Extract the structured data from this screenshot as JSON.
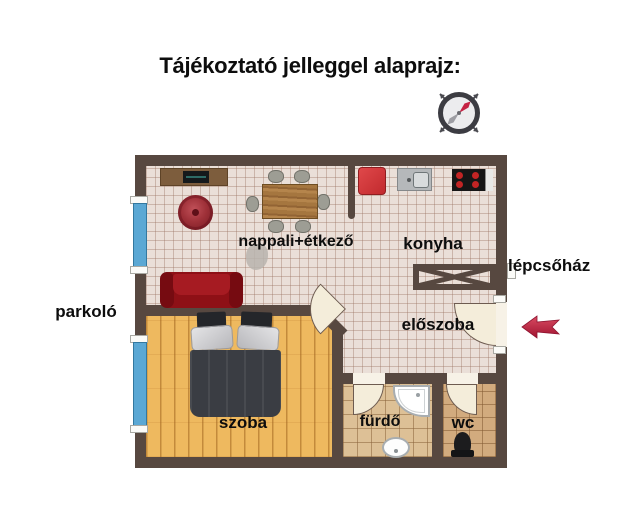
{
  "title": "Tájékoztató jelleggel alaprajz:",
  "rooms": {
    "nappali": {
      "label": "nappali+étkező"
    },
    "konyha": {
      "label": "konyha"
    },
    "eloszoba": {
      "label": "előszoba"
    },
    "szoba": {
      "label": "szoba"
    },
    "furdo": {
      "label": "fürdő"
    },
    "wc": {
      "label": "wc"
    }
  },
  "outside": {
    "parkolo": {
      "label": "parkoló"
    },
    "lepcsohaz": {
      "label": "lépcsőház"
    }
  },
  "icons": {
    "compass": "compass-icon",
    "entrance_arrow": "entrance-arrow-icon"
  },
  "colors": {
    "wall": "#574840",
    "tile_floor": "#eadfd8",
    "wood_floor": "#eeb95f",
    "bath_tile": "#ddc096",
    "wc_tile": "#d2ab7e",
    "window_blue": "#5ba8d4",
    "arrow_red": "#c2203e",
    "sofa_red": "#8e1016",
    "fridge_red": "#d43a3c",
    "bed_dark": "#3a3d43"
  }
}
